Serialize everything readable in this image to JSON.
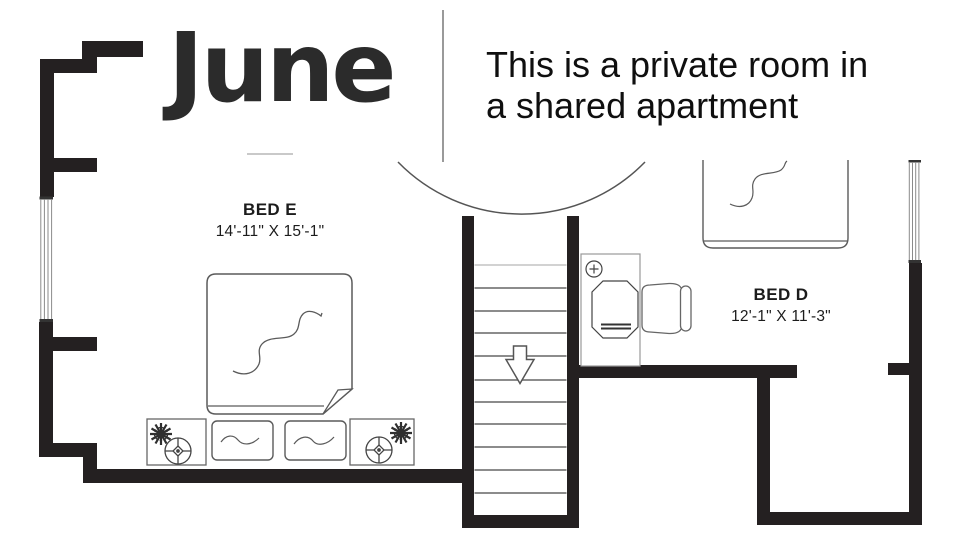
{
  "header": {
    "logo": "June",
    "tagline_line1": "This is a private room in",
    "tagline_line2": "a shared apartment"
  },
  "rooms": {
    "bed_e": {
      "label": "BED E",
      "dims": "14'-11\" X 15'-1\""
    },
    "bed_d": {
      "label": "BED D",
      "dims": "12'-1\" X 11'-3\""
    }
  },
  "symbols": {
    "bed_e_furniture": [
      "double-bed",
      "pillow",
      "pillow",
      "nightstand",
      "nightstand",
      "plant",
      "plant",
      "table-lamp",
      "table-lamp"
    ],
    "bed_d_furniture": [
      "bed",
      "desk",
      "office-chair",
      "ceiling-fixture"
    ],
    "circulation": [
      "staircase-going-down",
      "down-arrow",
      "door-swing-arc",
      "window",
      "window"
    ]
  },
  "colors": {
    "wall": "#242021",
    "furniture_line": "#5a5a5a",
    "text": "#1c1c1c",
    "logo": "#2b2b2b"
  }
}
